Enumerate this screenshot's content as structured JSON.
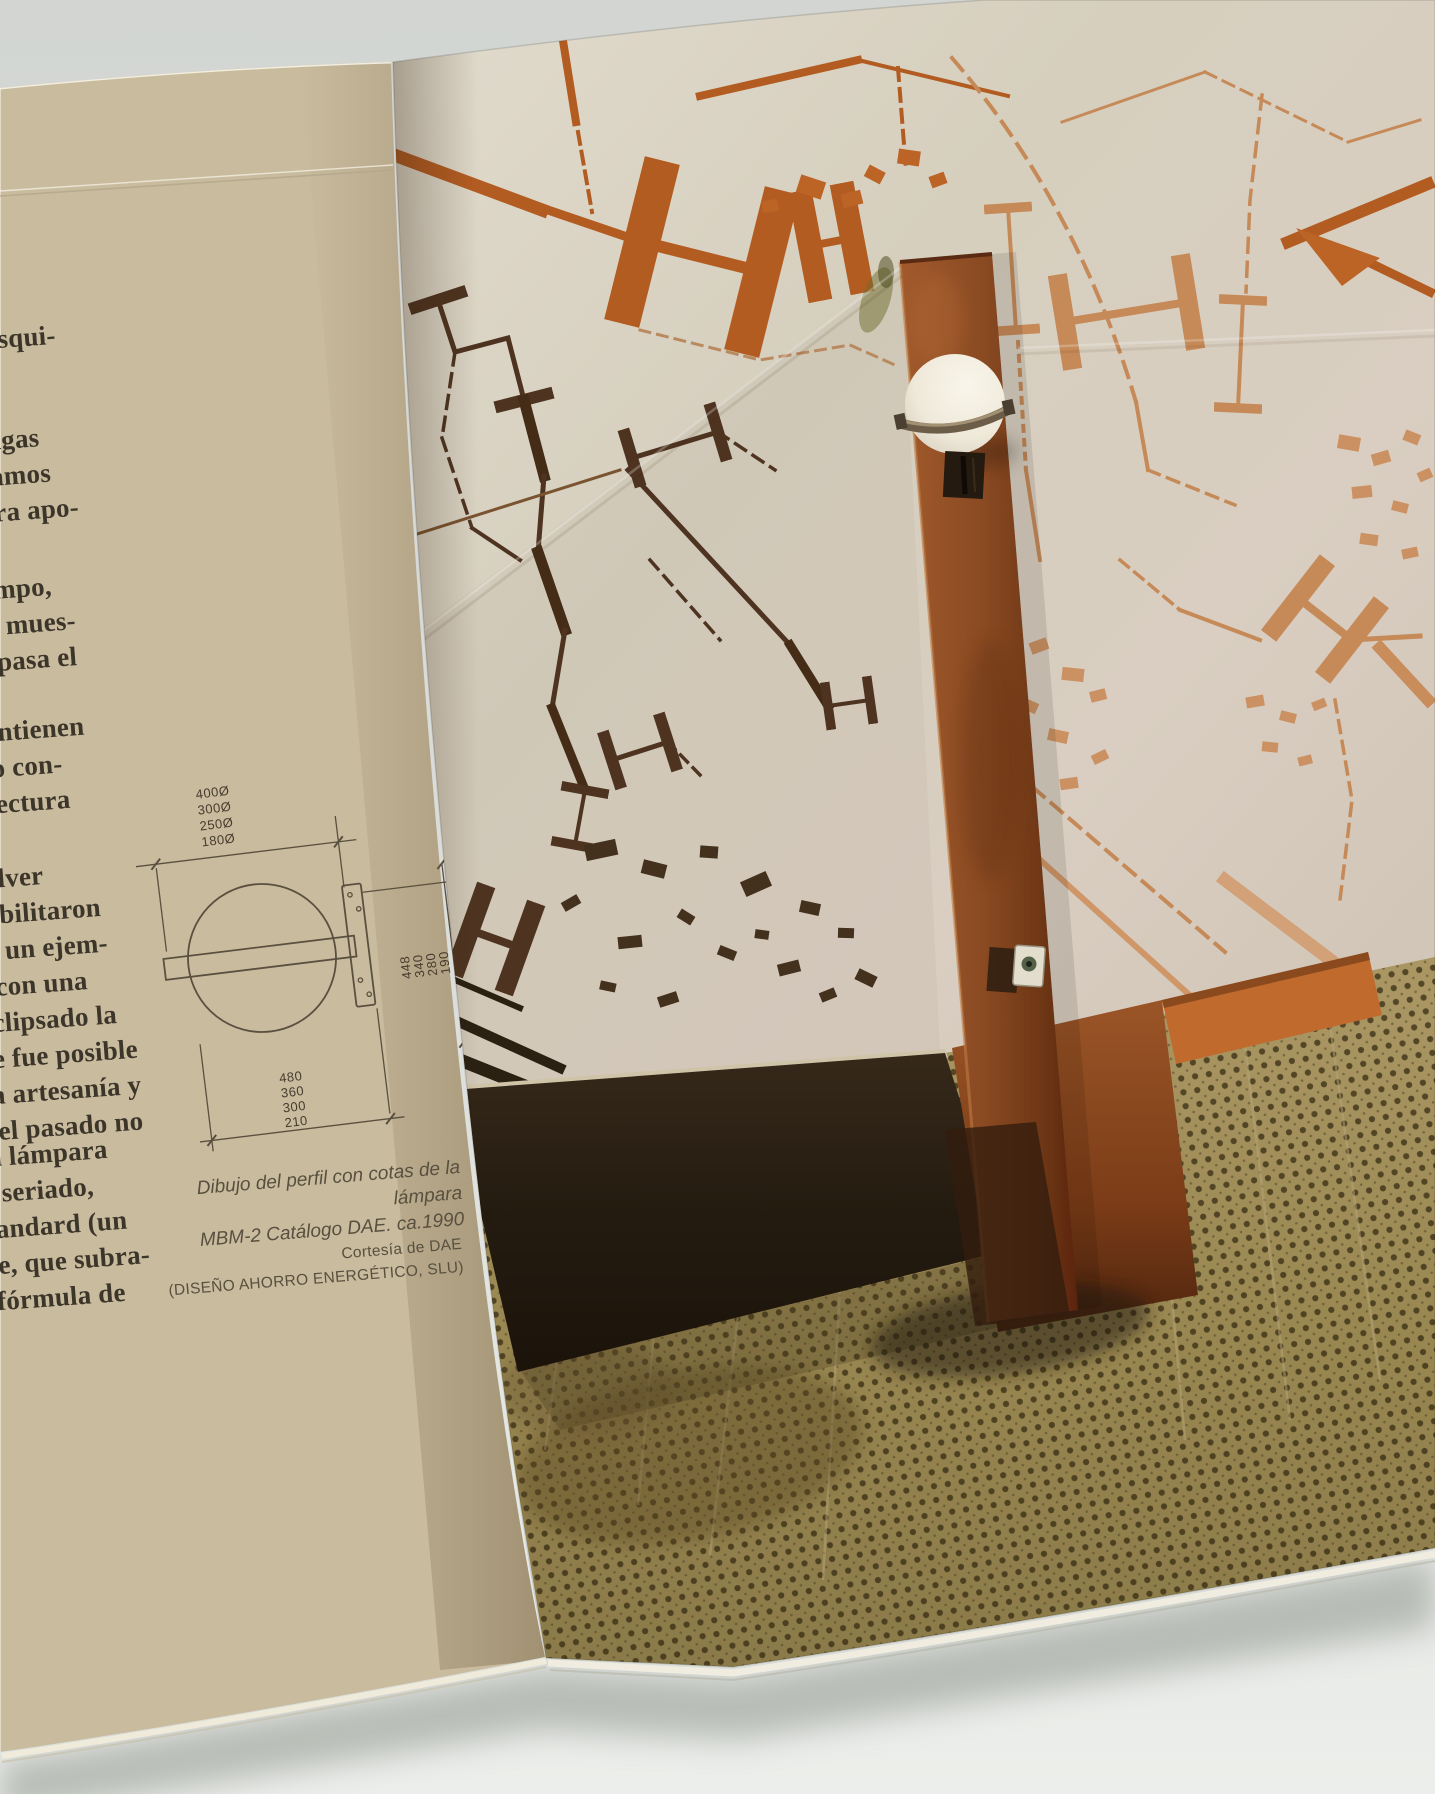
{
  "page_type": "open-book-spread-photograph",
  "left_page": {
    "text_fragments": [
      {
        "lines": [
          "esqui-"
        ]
      },
      {
        "lines": [
          "ragas",
          "ramos",
          "ara apo-"
        ]
      },
      {
        "lines": [
          "campo,",
          "da mues-",
          "aspasa el"
        ]
      },
      {
        "lines": [
          "lo contienen",
          "nudo con-",
          "quitectura"
        ]
      },
      {
        "lines": [
          "resolver",
          "posibilitaron",
          "2 es un ejem-",
          "as, con una",
          "a eclipsado la",
          "que fue posible",
          "e la artesanía y",
          "re el pasado no"
        ]
      },
      {
        "lines": [
          "o de esta lámpara",
          "roducto seriado,",
          "ento estandard (un",
          "e paisaje, que subra-",
          "en una fórmula de"
        ]
      }
    ],
    "diagram": {
      "top_dims": [
        "400Ø",
        "300Ø",
        "250Ø",
        "180Ø"
      ],
      "side_dims": [
        "448",
        "340",
        "280",
        "190"
      ],
      "bottom_dims": [
        "480",
        "360",
        "300",
        "210"
      ]
    },
    "caption_line1": "Dibujo del perfil con cotas de la lámpara",
    "caption_line2": "MBM-2 Catálogo DAE. ca.1990",
    "credit_line1": "Cortesía de DAE",
    "credit_line2": "(DISEÑO AHORRO ENERGÉTICO, SLU)"
  },
  "colors": {
    "background_gray": "#d4d7d4",
    "page_cream": "#e8e1ce",
    "wall_stucco": "#d6cfbf",
    "mural_dark": "#4e3420",
    "mural_orange": "#b35c22",
    "mural_terracotta": "#c68a58",
    "post_rust": "#8a4a22",
    "lamp_globe": "#f3efe3",
    "baseboard_dark": "#241b10",
    "floor_olive": "#998751"
  }
}
